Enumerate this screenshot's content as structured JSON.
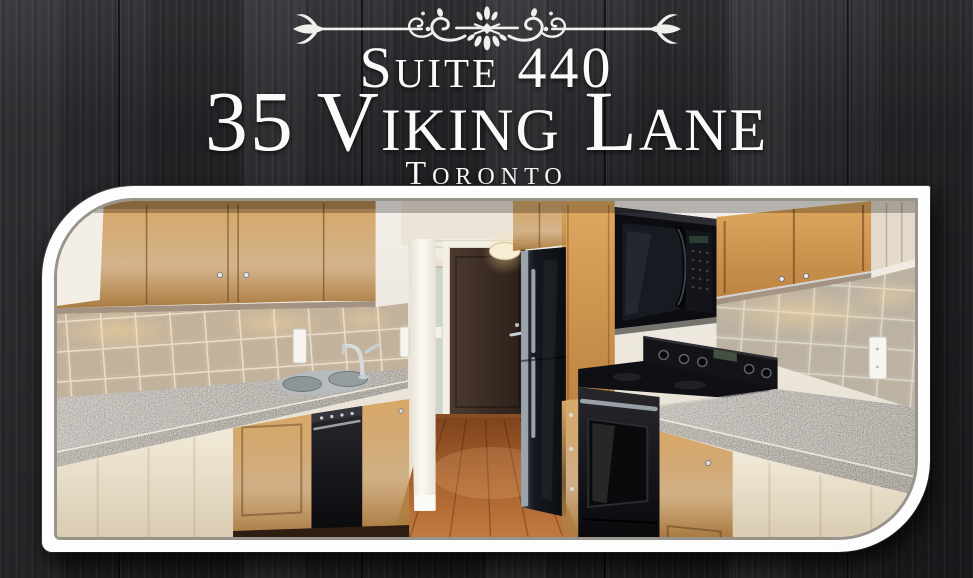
{
  "title": {
    "suite": "Suite 440",
    "address": "35 Viking Lane",
    "city": "Toronto"
  },
  "photo": {
    "description": "Galley kitchen with maple cabinets, beige tile backsplash, speckled granite countertops, stainless double sink, black dishwasher, fridge, over-range microwave and stove, dark brown entry door, mirrored closet, ceiling light and hardwood floor"
  },
  "ornament": {
    "icon": "decorative-flourish-divider"
  },
  "colors": {
    "background_wood": "#26282b",
    "title_text": "#fafaf8",
    "frame_border": "#ffffff"
  }
}
